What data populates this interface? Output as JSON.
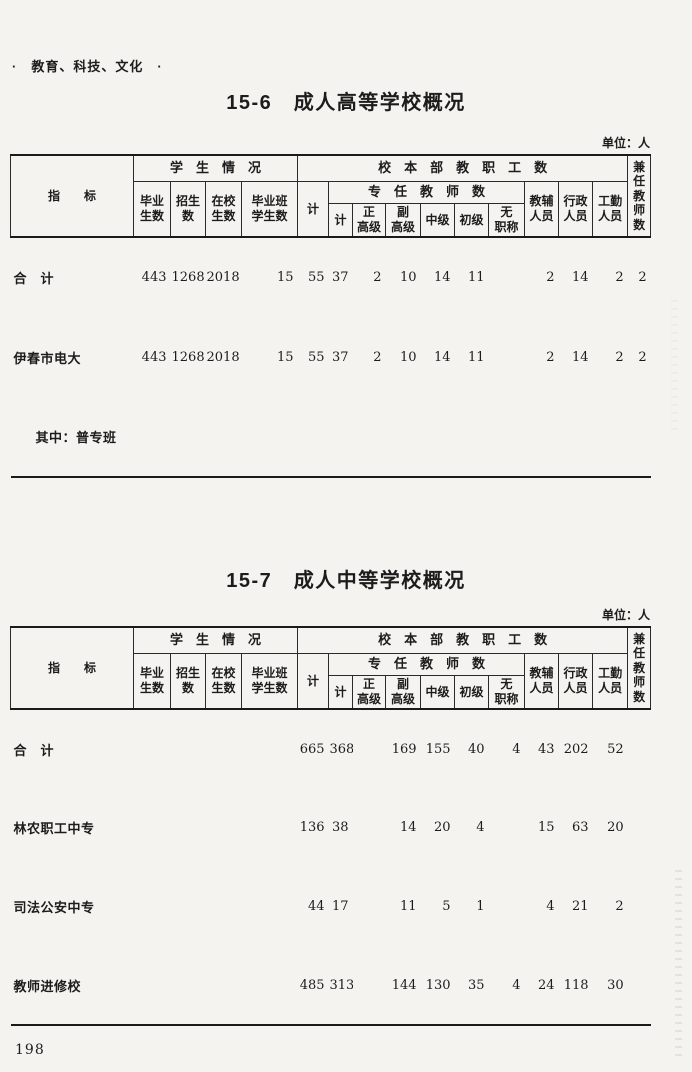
{
  "page": {
    "section_header": "·　教育、科技、文化　·",
    "page_number": "198"
  },
  "header_labels": {
    "indicator": "指　　标",
    "student_group": "学　生　情　况",
    "staff_group": "校　本　部　教　职　工　数",
    "fulltime_group": "专　任　教　师　数",
    "graduates": "毕业\n生数",
    "enrollment": "招生\n数",
    "current_students": "在校\n生数",
    "graduating_class": "毕业班\n学生数",
    "total_staff": "计",
    "total_fulltime": "计",
    "senior": "正\n高级",
    "assoc_senior": "副\n高级",
    "intermediate": "中级",
    "junior": "初级",
    "no_title": "无\n职称",
    "teaching_aux": "教辅\n人员",
    "admin": "行政\n人员",
    "logistics": "工勤\n人员",
    "parttime_teachers": "兼\n任\n教\n师\n数"
  },
  "tables": [
    {
      "title": "15-6　成人高等学校概况",
      "unit_label": "单位：人",
      "rows": [
        {
          "label": "合　计",
          "values": [
            "443",
            "1268",
            "2018",
            "15",
            "55",
            "37",
            "2",
            "10",
            "14",
            "11",
            "",
            "2",
            "14",
            "2",
            "2"
          ]
        },
        {
          "label": "伊春市电大",
          "values": [
            "443",
            "1268",
            "2018",
            "15",
            "55",
            "37",
            "2",
            "10",
            "14",
            "11",
            "",
            "2",
            "14",
            "2",
            "2"
          ]
        },
        {
          "label": "其中：普专班",
          "values": [
            "",
            "",
            "",
            "",
            "",
            "",
            "",
            "",
            "",
            "",
            "",
            "",
            "",
            "",
            ""
          ]
        }
      ]
    },
    {
      "title": "15-7　成人中等学校概况",
      "unit_label": "单位：人",
      "rows": [
        {
          "label": "合　计",
          "values": [
            "",
            "",
            "",
            "",
            "665",
            "368",
            "",
            "169",
            "155",
            "40",
            "4",
            "43",
            "202",
            "52",
            ""
          ]
        },
        {
          "label": "林农职工中专",
          "values": [
            "",
            "",
            "",
            "",
            "136",
            "38",
            "",
            "14",
            "20",
            "4",
            "",
            "15",
            "63",
            "20",
            ""
          ]
        },
        {
          "label": "司法公安中专",
          "values": [
            "",
            "",
            "",
            "",
            "44",
            "17",
            "",
            "11",
            "5",
            "1",
            "",
            "4",
            "21",
            "2",
            ""
          ]
        },
        {
          "label": "教师进修校",
          "values": [
            "",
            "",
            "",
            "",
            "485",
            "313",
            "",
            "144",
            "130",
            "35",
            "4",
            "24",
            "118",
            "30",
            ""
          ]
        }
      ]
    }
  ]
}
